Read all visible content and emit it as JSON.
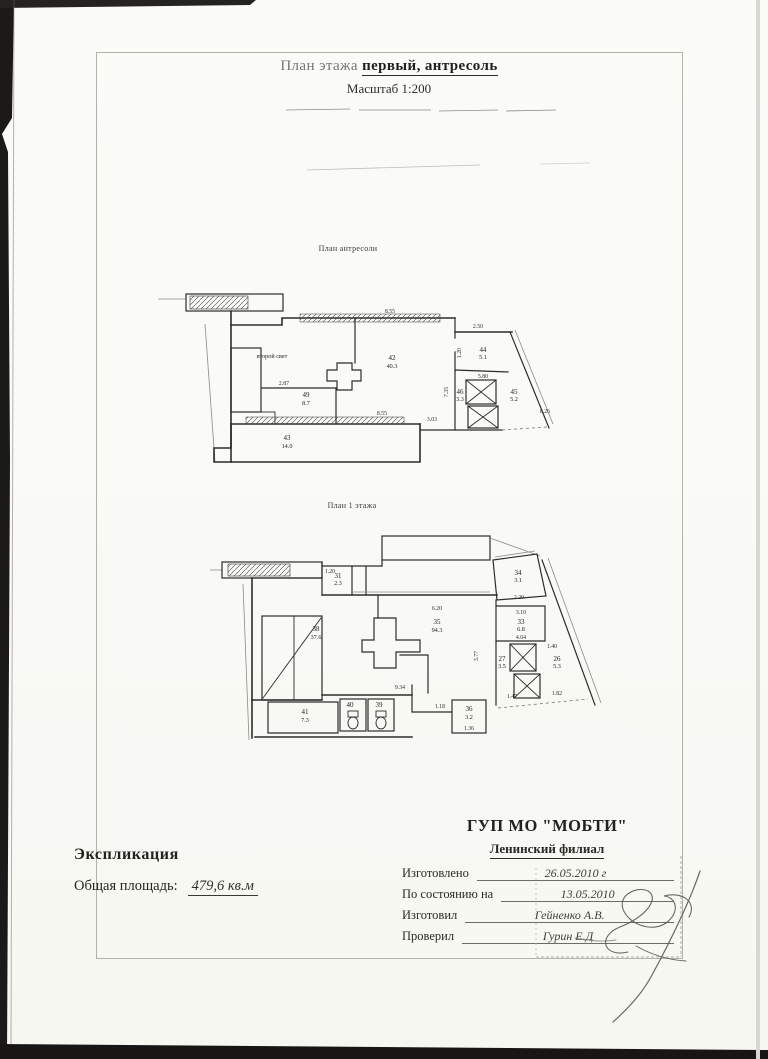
{
  "doc": {
    "title_prefix": "План этажа",
    "title_emphasis": "первый, антресоль",
    "scale": "Масштаб 1:200"
  },
  "mezzanine_plan": {
    "caption": "План антресоли",
    "annotation": "второй свет",
    "rooms": [
      {
        "num": "42",
        "area": "40.3"
      },
      {
        "num": "44",
        "area": "5.1"
      },
      {
        "num": "45",
        "area": "5.2"
      },
      {
        "num": "46",
        "area": "3.3"
      },
      {
        "num": "49",
        "area": "8.7"
      },
      {
        "num": "43",
        "area": "14.0"
      }
    ],
    "dimensions": [
      "8.55",
      "2.50",
      "5.80",
      "1.20",
      "7.35",
      "2.87",
      "8.55",
      "3.03",
      "0.26"
    ]
  },
  "first_floor_plan": {
    "caption": "План 1 этажа",
    "rooms": [
      {
        "num": "35",
        "area": "94.3"
      },
      {
        "num": "38",
        "area": "37.6"
      },
      {
        "num": "34",
        "area": "3.1"
      },
      {
        "num": "33",
        "area": "6.8"
      },
      {
        "num": "27",
        "area": "3.5"
      },
      {
        "num": "26",
        "area": "5.3"
      },
      {
        "num": "31",
        "area": "2.3"
      },
      {
        "num": "41",
        "area": "7.3"
      },
      {
        "num": "40",
        "area": ""
      },
      {
        "num": "39",
        "area": ""
      },
      {
        "num": "36",
        "area": "3.2"
      }
    ],
    "dimensions": [
      "6.20",
      "9.34",
      "1.18",
      "1.36",
      "2.20",
      "3.10",
      "4.04",
      "1.40",
      "1.47",
      "1.82",
      "1.20",
      "3.77"
    ]
  },
  "explication": {
    "heading": "Экспликация",
    "total_label": "Общая площадь:",
    "total_value": "479,6 кв.м"
  },
  "organization": {
    "name": "ГУП МО \"МОБТИ\"",
    "branch": "Ленинский филиал"
  },
  "stamp": {
    "rows": [
      {
        "label": "Изготовлено",
        "value": "26.05.2010 г"
      },
      {
        "label": "По состоянию на",
        "value": "13.05.2010"
      },
      {
        "label": "Изготовил",
        "value": "Гейненко А.В."
      },
      {
        "label": "Проверил",
        "value": "Гурин Е.Д"
      }
    ]
  }
}
